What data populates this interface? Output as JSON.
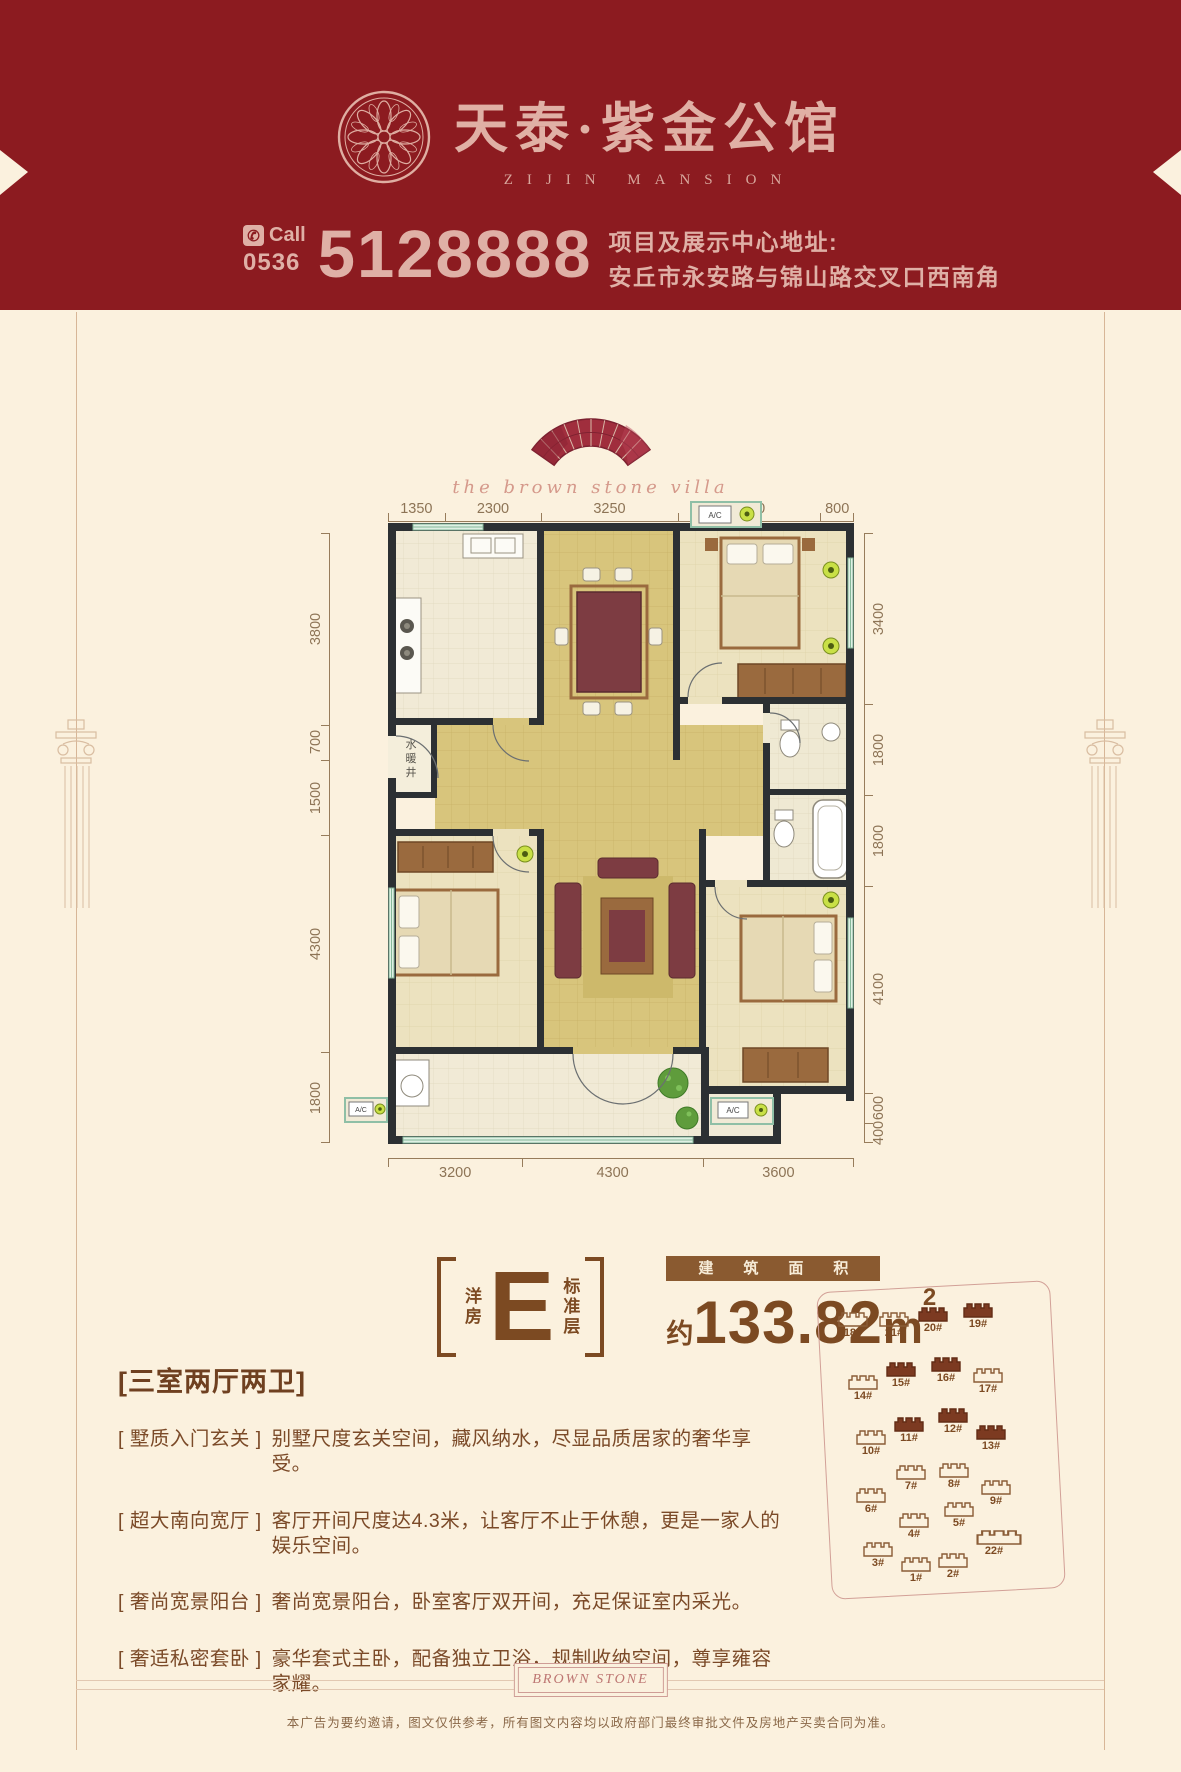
{
  "colors": {
    "banner_red": "#8c1b20",
    "cream": "#fbf1de",
    "pink_text": "#dfb0a6",
    "brown_text": "#7b4a28",
    "dim_text": "#8d7456",
    "gold_tile": "#d8c57c",
    "wall": "#2c3033",
    "lime_ac": "#c9e046",
    "filled_building": "#7c3a21"
  },
  "header": {
    "brand_cn": "天泰·紫金公馆",
    "brand_en": "ZIJIN MANSION",
    "call_label": "Call",
    "area_code": "0536",
    "phone": "5128888",
    "address_title": "项目及展示中心地址:",
    "address": "安丘市永安路与锦山路交叉口西南角"
  },
  "emblem": {
    "script": "the brown stone villa"
  },
  "floorplan": {
    "dims_top": [
      {
        "label": "1350",
        "flex": 1350
      },
      {
        "label": "2300",
        "flex": 2300
      },
      {
        "label": "3250",
        "flex": 3250
      },
      {
        "label": "3400",
        "flex": 3400
      },
      {
        "label": "800",
        "flex": 800
      }
    ],
    "dims_bottom": [
      {
        "label": "3200",
        "flex": 3200
      },
      {
        "label": "4300",
        "flex": 4300
      },
      {
        "label": "3600",
        "flex": 3600
      }
    ],
    "dims_left": [
      {
        "label": "3800",
        "flex": 3800
      },
      {
        "label": "700",
        "flex": 700
      },
      {
        "label": "1500",
        "flex": 1500
      },
      {
        "label": "4300",
        "flex": 4300
      },
      {
        "label": "1800",
        "flex": 1800
      }
    ],
    "dims_right": [
      {
        "label": "3400",
        "flex": 3400
      },
      {
        "label": "1800",
        "flex": 1800
      },
      {
        "label": "1800",
        "flex": 1800
      },
      {
        "label": "4100",
        "flex": 4100
      },
      {
        "label": "600",
        "flex": 600
      },
      {
        "label": "400",
        "flex": 400
      }
    ],
    "shaft": [
      "水",
      "暖",
      "井"
    ],
    "ac_label": "A/C"
  },
  "unit": {
    "type_vertical_left": "洋房",
    "letter": "E",
    "type_vertical_right": "标准层",
    "area_label": "建筑面积",
    "area_prefix": "约",
    "area_value": "133.82",
    "area_unit": "m",
    "area_sup": "2"
  },
  "features": {
    "heading": "[三室两厅两卫]",
    "items": [
      {
        "tag": "[ 墅质入门玄关 ]",
        "text": "别墅尺度玄关空间，藏风纳水，尽显品质居家的奢华享受。"
      },
      {
        "tag": "[ 超大南向宽厅 ]",
        "text": "客厅开间尺度达4.3米，让客厅不止于休憩，更是一家人的娱乐空间。"
      },
      {
        "tag": "[ 奢尚宽景阳台 ]",
        "text": "奢尚宽景阳台，卧室客厅双开间，充足保证室内采光。"
      },
      {
        "tag": "[ 奢适私密套卧 ]",
        "text": "豪华套式主卧，配备独立卫浴，规制收纳空间，尊享雍容家耀。"
      }
    ]
  },
  "siteplan": {
    "buildings": [
      {
        "label": "18#",
        "x": 17,
        "y": 35,
        "filled": false
      },
      {
        "label": "21#",
        "x": 58,
        "y": 35,
        "filled": false
      },
      {
        "label": "20#",
        "x": 97,
        "y": 30,
        "filled": true
      },
      {
        "label": "19#",
        "x": 142,
        "y": 26,
        "filled": true
      },
      {
        "label": "14#",
        "x": 27,
        "y": 98,
        "filled": false
      },
      {
        "label": "15#",
        "x": 65,
        "y": 85,
        "filled": true
      },
      {
        "label": "16#",
        "x": 110,
        "y": 80,
        "filled": true
      },
      {
        "label": "17#",
        "x": 152,
        "y": 91,
        "filled": false
      },
      {
        "label": "10#",
        "x": 35,
        "y": 153,
        "filled": false
      },
      {
        "label": "11#",
        "x": 73,
        "y": 140,
        "filled": true
      },
      {
        "label": "12#",
        "x": 117,
        "y": 131,
        "filled": true
      },
      {
        "label": "13#",
        "x": 155,
        "y": 148,
        "filled": true
      },
      {
        "label": "6#",
        "x": 35,
        "y": 211,
        "filled": false
      },
      {
        "label": "7#",
        "x": 75,
        "y": 188,
        "filled": false
      },
      {
        "label": "8#",
        "x": 118,
        "y": 186,
        "filled": false
      },
      {
        "label": "9#",
        "x": 160,
        "y": 203,
        "filled": false
      },
      {
        "label": "4#",
        "x": 78,
        "y": 236,
        "filled": false
      },
      {
        "label": "5#",
        "x": 123,
        "y": 225,
        "filled": false
      },
      {
        "label": "3#",
        "x": 42,
        "y": 265,
        "filled": false
      },
      {
        "label": "1#",
        "x": 80,
        "y": 280,
        "filled": false
      },
      {
        "label": "2#",
        "x": 117,
        "y": 276,
        "filled": false
      },
      {
        "label": "22#",
        "x": 158,
        "y": 253,
        "filled": false,
        "wide": true
      }
    ]
  },
  "footer": {
    "stamp": "BROWN STONE",
    "disclaimer": "本广告为要约邀请，图文仅供参考，所有图文内容均以政府部门最终审批文件及房地产买卖合同为准。"
  }
}
